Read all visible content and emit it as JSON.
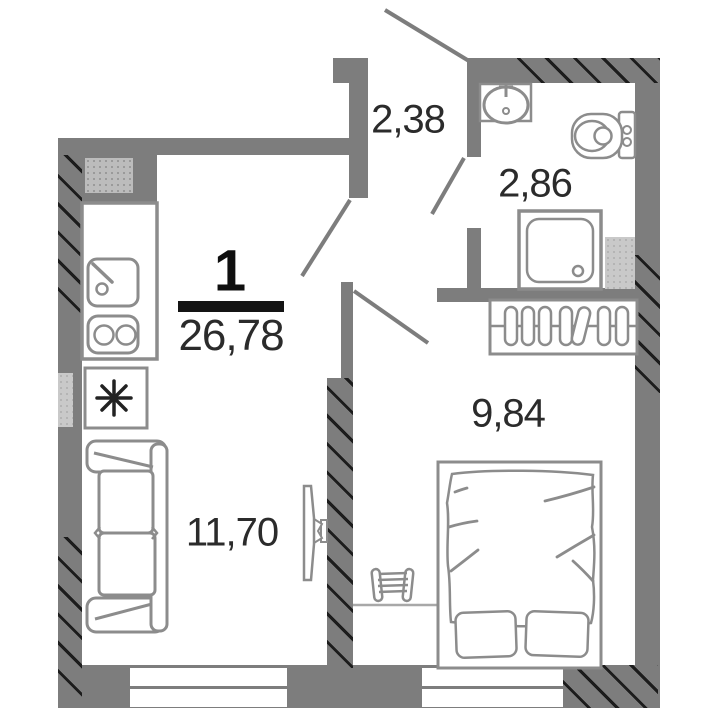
{
  "floorplan": {
    "apartment_number": "1",
    "total_area": "26,78",
    "rooms": {
      "hallway": {
        "name": "hallway",
        "area": "2,38"
      },
      "bathroom": {
        "name": "bathroom",
        "area": "2,86"
      },
      "bedroom": {
        "name": "bedroom",
        "area": "9,84"
      },
      "living_room": {
        "name": "living-room-kitchen",
        "area": "11,70"
      }
    },
    "colors": {
      "wall": "#7d7d7d",
      "fixture_stroke": "#8c8c8c",
      "hatch_line": "#1c1c1c",
      "label_text": "#2b2b2b",
      "number_text": "#0f0f0f"
    },
    "icons": {
      "fridge_star_icon": "8-ray asterisk",
      "hanger_icon": "clothes hangers on rail",
      "door_swing_icon": "diagonal door leaf line"
    }
  }
}
